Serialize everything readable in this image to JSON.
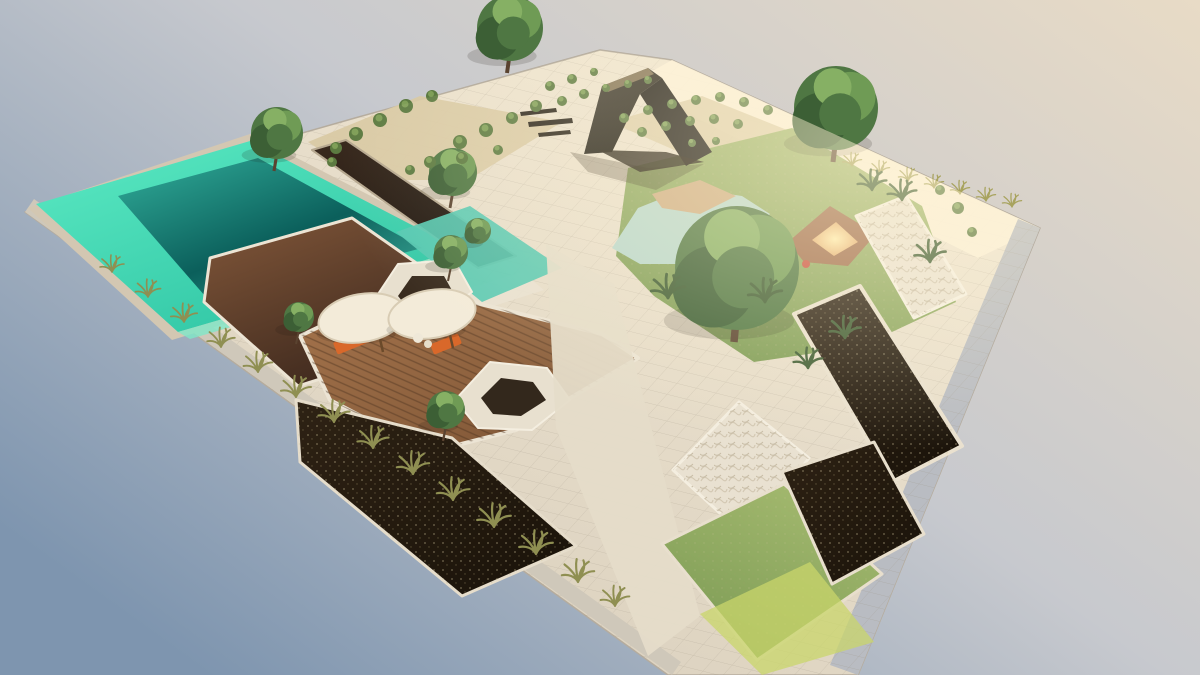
{
  "scene": {
    "title": "Aerial 3D render of a landscaped garden plot",
    "view": "high-angle axonometric render floating on a gradient backdrop",
    "lighting": "warm sun from upper right, cool blue shade lower left"
  },
  "canvas": {
    "width": 1200,
    "height": 675
  },
  "colors": {
    "sky_top_right": "#e8dbc6",
    "sky_mid": "#c7c9ce",
    "sky_bottom_left": "#7e95af",
    "paving_light": "#f3e9d5",
    "paving_dark": "#d6ccba",
    "sun_glow": "#fff3d2",
    "pool_rim_light": "#5ceac3",
    "pool_rim_dark": "#2cc2a2",
    "pool_deep_light": "#2fa896",
    "pool_deep_dark": "#0b5f5b",
    "channel_dark_top": "#3a2a1e",
    "channel_dark_bottom": "#150f0a",
    "terrace_light": "#7c5337",
    "terrace_dark": "#35231a",
    "deck_light": "#a5744c",
    "deck_dark": "#7a5233",
    "mulch_light": "#2e2214",
    "mulch_dark": "#191209",
    "lawn_light": "#a6bb70",
    "lawn_dark": "#7b9a54",
    "pond": "#b9d8cd",
    "sand": "#cfae84",
    "glow_center": "#ffedb0",
    "glow_edge": "#dd9a60",
    "pavilion_light": "#4a443a",
    "pavilion_dark": "#121008",
    "stone_white": "#e9e1d1",
    "gray_paver": "#b9bcc2",
    "stone_band": "#cfc8ba",
    "tree_base": "#4f7743",
    "tree_shade": "#3c5f35",
    "tree_light": "#6f9b55",
    "tree_top": "#86b064",
    "trunk": "#5a4330",
    "tuft": "#8f8f52",
    "tuft_sun": "#a8a35e",
    "palm": "#3e5c33",
    "shrub": "#5c7a41",
    "shrub_light": "#7f9f58",
    "umbrella": "#f3ebd9",
    "umbrella_edge": "#d8ccb4",
    "lounger": "#d9682a",
    "accent_red": "#c94f3f"
  },
  "surfaces": [
    {
      "name": "plot-base",
      "points": "25,212 355,118 600,50 672,60 1040,228 858,675 668,675",
      "fill": "@gBase",
      "stroke": "#b5ac9e",
      "strokeWidth": 1.5,
      "pattern": "pGrid",
      "patternOp": 0.3
    },
    {
      "name": "sunlit-wall",
      "points": "640,78 672,60 1040,228 978,258 700,120",
      "fill": "#fdf2da",
      "opacity": 0.85
    },
    {
      "name": "stone-band-left-edge",
      "points": "25,212 672,675 681,662 34,199",
      "fill": "#cfc8ba"
    },
    {
      "name": "paver-band-right-edge",
      "points": "1040,228 858,675 830,665 1018,219",
      "fill": "#b9bcc2",
      "pattern": "pGrid",
      "patternOp": 0.35
    },
    {
      "name": "gravel-bed-top-left",
      "points": "308,142 420,96 562,122 468,180 366,180",
      "fill": "#d9c9a4",
      "opacity": 0.95
    },
    {
      "name": "gravel-bed-top-right",
      "points": "610,122 702,96 792,132 702,162",
      "fill": "#dbcba6",
      "opacity": 0.85
    },
    {
      "name": "pool-coping",
      "points": "28,208 250,134 472,248 172,340",
      "fill": "#d3c7b2"
    },
    {
      "name": "pool-shallow-rim",
      "points": "36,204 250,141 460,250 178,332",
      "fill": "@gRim"
    },
    {
      "name": "pool-deep-water",
      "points": "118,196 258,158 422,248 212,304",
      "fill": "@gPool"
    },
    {
      "name": "pool-shelf-glint",
      "points": "178,332 460,250 470,257 190,339",
      "fill": "#7fe7c8",
      "opacity": 0.8
    },
    {
      "name": "reflecting-channel",
      "points": "312,150 346,140 516,256 478,268",
      "fill": "@gChan",
      "stroke": "#b6a890",
      "strokeWidth": 2
    },
    {
      "name": "stepping-walkway",
      "points": "430,300 522,272 544,290 450,320",
      "fill": "#e9e1d1",
      "opacity": 0.9
    },
    {
      "name": "teal-channel",
      "points": "396,232 470,206 562,268 482,302",
      "fill": "#57c9b2",
      "opacity": 0.92
    },
    {
      "name": "brown-marble-terrace",
      "points": "210,258 352,218 472,302 470,332 298,386 204,302",
      "fill": "@gTerr",
      "stroke": "#ece4d4",
      "strokeWidth": 3
    },
    {
      "name": "wood-deck",
      "points": "300,336 380,298 472,302 602,334 638,358 516,430 430,452 330,400",
      "fill": "@gDeck",
      "stroke": "#ece4d4",
      "strokeWidth": 4,
      "pattern": "pStripes",
      "patternOp": 0.45
    },
    {
      "name": "nest-planter-a-outer",
      "points": "374,300 398,264 454,260 472,292 438,318 390,320",
      "fill": "#e8e0cf",
      "stroke": "#f4eee0",
      "strokeWidth": 2
    },
    {
      "name": "nest-planter-a-pit",
      "points": "398,296 412,276 444,276 454,294 428,308 406,306",
      "fill": "#392b1e"
    },
    {
      "name": "nest-planter-b-outer",
      "points": "455,400 490,362 547,368 570,400 532,430 478,428",
      "fill": "#e8e0cf",
      "stroke": "#f4eee0",
      "strokeWidth": 2
    },
    {
      "name": "nest-planter-b-pit",
      "points": "481,398 501,378 533,382 546,400 521,416 493,414",
      "fill": "#33281c"
    },
    {
      "name": "mulch-bed-large",
      "points": "296,400 452,438 576,546 462,596 300,462",
      "fill": "@gMulch",
      "stroke": "#e6ddcb",
      "strokeWidth": 3,
      "pattern": "pSpeck",
      "patternOp": 0.6
    },
    {
      "name": "central-path",
      "points": "546,244 614,284 700,616 648,656 556,428",
      "fill": "#e5dcc9",
      "opacity": 0.95
    },
    {
      "name": "lawn-right",
      "points": "628,168 792,128 922,206 956,302 862,346 754,362 654,296 616,256",
      "fill": "@gLawn",
      "pattern": "pSpeck",
      "patternOp": 0.25
    },
    {
      "name": "pond",
      "points": "612,248 638,208 688,188 742,196 770,214 738,244 688,264 640,264",
      "fill": "#b9d8cd"
    },
    {
      "name": "pond-sand-island",
      "points": "652,194 700,180 736,196 700,214 662,208",
      "fill": "#cfae84"
    },
    {
      "name": "sunken-lounge-rim",
      "points": "788,242 830,206 876,234 848,266 804,262",
      "fill": "#a06c4c"
    },
    {
      "name": "sunken-lounge-glow",
      "points": "812,240 836,222 858,242 834,256",
      "fill": "@gGlow"
    },
    {
      "name": "rock-planter-upper",
      "points": "856,216 906,196 966,294 914,318",
      "fill": "#ebe3d3",
      "stroke": "#f6f0e2",
      "strokeWidth": 3,
      "pattern": "pRock",
      "patternOp": 0.7
    },
    {
      "name": "mulch-planter-long",
      "points": "794,314 860,286 962,446 892,482",
      "fill": "@gMulch",
      "stroke": "#eae1cf",
      "strokeWidth": 4,
      "pattern": "pSpeck",
      "patternOp": 0.6
    },
    {
      "name": "rock-planter-big",
      "points": "673,470 739,402 809,458 747,538",
      "fill": "#e9e1d1",
      "stroke": "#f4eee0",
      "strokeWidth": 3,
      "pattern": "pRock",
      "patternOp": 0.7
    },
    {
      "name": "lawn-bottom-right",
      "points": "662,544 784,484 882,574 757,660",
      "fill": "@gLawn",
      "stroke": "#e8dfcd",
      "strokeWidth": 3,
      "pattern": "pSpeck",
      "patternOp": 0.25
    },
    {
      "name": "lawn-bright-patch",
      "points": "700,614 810,562 874,642 762,675",
      "fill": "#c9d66b",
      "opacity": 0.75
    },
    {
      "name": "mulch-bed-right",
      "points": "782,472 874,442 924,534 832,584",
      "fill": "@gMulch",
      "stroke": "#e8dfcd",
      "strokeWidth": 3,
      "pattern": "pSpeck",
      "patternOp": 0.6
    },
    {
      "name": "pavilion-shadow",
      "points": "570,152 648,168 704,164 656,190 588,172",
      "fill": "#2e2417",
      "opacity": 0.28
    }
  ],
  "pavilion": [
    {
      "name": "pavilion-left-leg",
      "points": "584,154 602,86 648,68 662,78 640,94 612,152",
      "fill": "@gPav"
    },
    {
      "name": "pavilion-right-slab",
      "points": "640,94 662,78 712,152 686,166",
      "fill": "#1d1a15"
    },
    {
      "name": "pavilion-top-light",
      "points": "602,86 648,68 654,74 608,92",
      "fill": "#93815f",
      "opacity": 0.8
    },
    {
      "name": "pavilion-base",
      "points": "598,150 666,152 704,162 640,172",
      "fill": "#231c12",
      "opacity": 0.85
    },
    {
      "name": "bench-plank-1",
      "points": "520,112 556,108 557,112 521,116",
      "fill": "#2a241b"
    },
    {
      "name": "bench-plank-2",
      "points": "528,122 572,118 573,123 529,127",
      "fill": "#2a241b"
    },
    {
      "name": "bench-plank-3",
      "points": "538,133 570,130 571,134 539,137",
      "fill": "#2a241b"
    }
  ],
  "trees": [
    {
      "x": 510,
      "y": 28,
      "r": 33
    },
    {
      "x": 277,
      "y": 133,
      "r": 26
    },
    {
      "x": 453,
      "y": 172,
      "r": 24
    },
    {
      "x": 478,
      "y": 231,
      "r": 13
    },
    {
      "x": 451,
      "y": 252,
      "r": 17
    },
    {
      "x": 299,
      "y": 317,
      "r": 15
    },
    {
      "x": 446,
      "y": 410,
      "r": 19
    },
    {
      "x": 836,
      "y": 108,
      "r": 42
    },
    {
      "x": 737,
      "y": 268,
      "r": 62
    }
  ],
  "grass_tufts_left": [
    [
      112,
      272,
      1.0
    ],
    [
      148,
      297,
      1.05
    ],
    [
      184,
      322,
      1.1
    ],
    [
      221,
      347,
      1.15
    ],
    [
      258,
      372,
      1.2
    ],
    [
      296,
      397,
      1.25
    ],
    [
      334,
      422,
      1.3
    ],
    [
      373,
      448,
      1.3
    ],
    [
      413,
      474,
      1.35
    ],
    [
      453,
      500,
      1.35
    ],
    [
      494,
      527,
      1.4
    ],
    [
      536,
      554,
      1.4
    ],
    [
      578,
      582,
      1.35
    ],
    [
      615,
      606,
      1.2
    ]
  ],
  "grass_tufts_topright": [
    [
      852,
      166,
      0.8
    ],
    [
      880,
      174,
      0.8
    ],
    [
      908,
      181,
      0.8
    ],
    [
      934,
      188,
      0.8
    ],
    [
      960,
      194,
      0.8
    ],
    [
      986,
      201,
      0.8
    ],
    [
      1012,
      207,
      0.8
    ]
  ],
  "palms": [
    [
      668,
      298,
      1.4
    ],
    [
      765,
      302,
      1.4
    ],
    [
      845,
      338,
      1.3
    ],
    [
      872,
      190,
      1.2
    ],
    [
      902,
      200,
      1.2
    ],
    [
      930,
      262,
      1.3
    ],
    [
      808,
      368,
      1.2
    ]
  ],
  "shrubs": [
    [
      336,
      148,
      6
    ],
    [
      356,
      134,
      7
    ],
    [
      380,
      120,
      7
    ],
    [
      406,
      106,
      7
    ],
    [
      432,
      96,
      6
    ],
    [
      460,
      142,
      7
    ],
    [
      486,
      130,
      7
    ],
    [
      512,
      118,
      6
    ],
    [
      536,
      106,
      6
    ],
    [
      430,
      162,
      6
    ],
    [
      462,
      158,
      6
    ],
    [
      498,
      150,
      5
    ],
    [
      332,
      162,
      5
    ],
    [
      410,
      170,
      5
    ],
    [
      550,
      86,
      5
    ],
    [
      572,
      79,
      5
    ],
    [
      594,
      72,
      4
    ],
    [
      562,
      101,
      5
    ],
    [
      584,
      94,
      5
    ],
    [
      606,
      88,
      4
    ],
    [
      628,
      84,
      4
    ],
    [
      648,
      80,
      4
    ],
    [
      624,
      118,
      5
    ],
    [
      648,
      110,
      5
    ],
    [
      672,
      104,
      5
    ],
    [
      696,
      100,
      5
    ],
    [
      720,
      97,
      5
    ],
    [
      744,
      102,
      5
    ],
    [
      768,
      110,
      5
    ],
    [
      642,
      132,
      5
    ],
    [
      666,
      126,
      5
    ],
    [
      690,
      121,
      5
    ],
    [
      714,
      119,
      5
    ],
    [
      738,
      124,
      5
    ],
    [
      692,
      143,
      4
    ],
    [
      716,
      141,
      4
    ],
    [
      958,
      208,
      6
    ],
    [
      972,
      232,
      5
    ],
    [
      940,
      190,
      5
    ]
  ],
  "umbrellas": [
    {
      "cx": 362,
      "cy": 318,
      "rx": 44,
      "ry": 24,
      "lounger": {
        "x": 352,
        "y": 342,
        "w": 36,
        "h": 13,
        "rot": -22
      }
    },
    {
      "cx": 432,
      "cy": 314,
      "rx": 44,
      "ry": 24,
      "lounger": {
        "x": 446,
        "y": 344,
        "w": 30,
        "h": 11,
        "rot": -22
      }
    }
  ],
  "accents": [
    {
      "name": "red-pot",
      "x": 806,
      "y": 264,
      "r": 4,
      "fill": "#c94f3f"
    },
    {
      "name": "white-boulder",
      "x": 418,
      "y": 338,
      "r": 5,
      "fill": "#efe8d8"
    },
    {
      "name": "white-boulder",
      "x": 428,
      "y": 344,
      "r": 4,
      "fill": "#e6ddc9"
    }
  ]
}
